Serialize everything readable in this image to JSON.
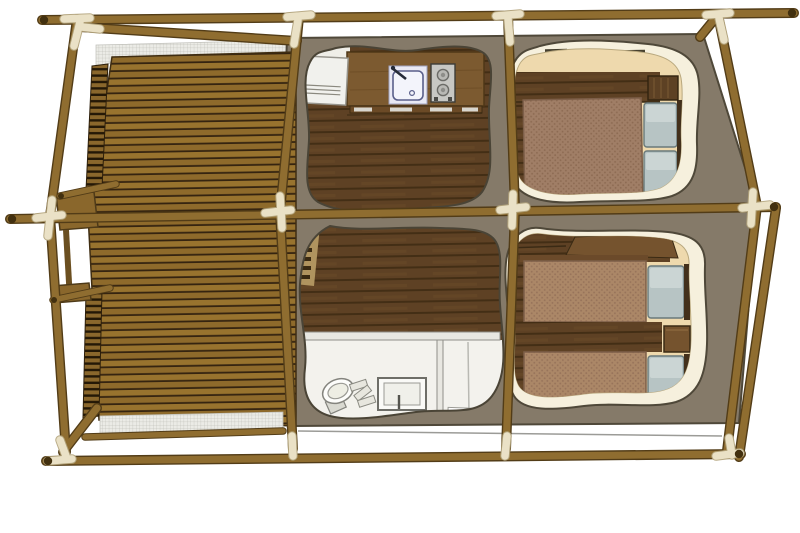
{
  "scene": {
    "description": "Top-down 3D rendering of a safari glamping tent floor plan with timber pole frame and wooden deck",
    "sections": [
      {
        "id": "deck",
        "label": "wooden-deck-terrace",
        "features": [
          "horizontal plank decking",
          "side railings",
          "entry step platform",
          "insect mesh edge"
        ]
      },
      {
        "id": "kitchen",
        "label": "kitchen",
        "features": [
          "fridge",
          "counter",
          "sink with faucet",
          "two-burner stove",
          "utensil rail",
          "dark plank floor"
        ]
      },
      {
        "id": "bedroom-double",
        "label": "double-bedroom",
        "features": [
          "double bed",
          "two pillows",
          "headboard cabinet",
          "wardrobe shelf band",
          "cream floor"
        ]
      },
      {
        "id": "living-bathroom",
        "label": "living-area-and-bathroom",
        "features": [
          "dark plank floor",
          "partition wall",
          "toilet",
          "shower tray with drain",
          "step shelf"
        ]
      },
      {
        "id": "bedroom-twin",
        "label": "twin-bedroom",
        "features": [
          "two single beds",
          "two pillows",
          "nightstand",
          "shelf band",
          "cream floor"
        ]
      }
    ],
    "frame": {
      "material": "timber-poles",
      "joints": "cream-lashings",
      "netting": "mesh-over-deck-edges"
    }
  },
  "colors": {
    "background": "#ffffff",
    "pole": "#8f6d30",
    "pole_edge": "#523c17",
    "pole_tip": "#42300f",
    "joint_cream": "#eae1c6",
    "joint_cream_edge": "#b3a47c",
    "canvas": "#857a69",
    "canvas_edge": "#4f4839",
    "blob_rim": "#f6f0dd",
    "deck_plank_a": "#8e6a2b",
    "deck_plank_b": "#98732e",
    "deck_gap": "#352410",
    "rail_wood": "#8a672c",
    "rail_gap": "#241806",
    "floor_dark": "#5e4124",
    "floor_line": "#432e15",
    "floor_streak": "#6a4a28",
    "floor_cream": "#eed9ad",
    "wood_mid": "#75532e",
    "counter": "#7c5a30",
    "blanket_double": "#a07e66",
    "blanket_double_dot": "#8d6b53",
    "blanket_single": "#ab8767",
    "blanket_single_dot": "#97735a",
    "pillow": "#b7c4c4",
    "pillow_highlight": "#d2dbd9",
    "pillow_edge": "#69797b",
    "bedframe_dark": "#43301b",
    "headboard": "#5d4124",
    "fridge": "#f1f1ed",
    "appliance_grey": "#c7c7c3",
    "sink_body": "#e9e9f4",
    "sink_basin": "#f3f4fb",
    "sink_line": "#5a5f8a",
    "faucet": "#252b38",
    "bath_floor": "#f3f2ed",
    "bath_wall": "#e8e7e1",
    "bath_wall_edge": "#8f8f89",
    "fixture_white": "#fdfdfb",
    "fixture_fill": "#e7e6de",
    "fixture_edge": "#84847e",
    "mesh_bg": "#ebebe6",
    "mesh_line": "#b5b5ae",
    "cable": "#9b9b97",
    "vent_dark": "#46402f",
    "entry_wood": "#b0945f"
  }
}
